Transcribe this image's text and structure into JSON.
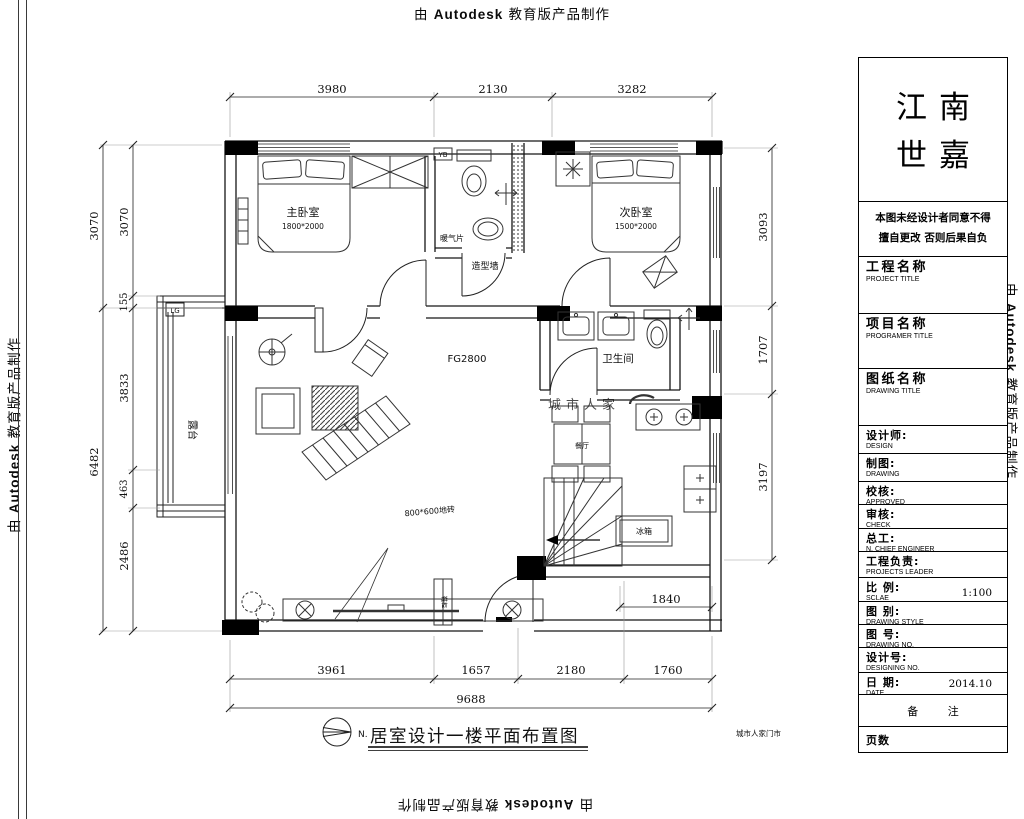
{
  "watermark": {
    "prefix": "由 ",
    "brand": "Autodesk",
    "suffix": " 教育版产品制作"
  },
  "sheet": {
    "brand_name_line1": "江南",
    "brand_name_line2": "世嘉",
    "notice_line1": "本图未经设计者同意不得",
    "notice_line2": "擅自更改 否则后果自负",
    "fields": [
      {
        "label": "工程名称",
        "sub": "PROJECT TITLE",
        "value": ""
      },
      {
        "label": "项目名称",
        "sub": "PROGRAMER TITLE",
        "value": ""
      },
      {
        "label": "图纸名称",
        "sub": "DRAWING TITLE",
        "value": ""
      },
      {
        "label": "设计师:",
        "sub": "DESIGN",
        "value": ""
      },
      {
        "label": "制图:",
        "sub": "DRAWING",
        "value": ""
      },
      {
        "label": "校核:",
        "sub": "APPROVED",
        "value": ""
      },
      {
        "label": "审核:",
        "sub": "CHECK",
        "value": ""
      },
      {
        "label": "总工:",
        "sub": "N. CHIEF ENGINEER",
        "value": ""
      },
      {
        "label": "工程负责:",
        "sub": "PROJECTS LEADER",
        "value": ""
      },
      {
        "label": "比 例:",
        "sub": "SCLAE",
        "value": "1:100"
      },
      {
        "label": "图 别:",
        "sub": "DRAWING STYLE",
        "value": ""
      },
      {
        "label": "图 号:",
        "sub": "DRAWING NO.",
        "value": ""
      },
      {
        "label": "设计号:",
        "sub": "DESIGNING NO.",
        "value": ""
      },
      {
        "label": "日 期:",
        "sub": "DATE",
        "value": "2014.10"
      }
    ],
    "remark": "备 注",
    "pages": "页数"
  },
  "plan": {
    "rooms": {
      "master_bedroom": "主卧室",
      "master_bed_size": "1800*2000",
      "second_bedroom": "次卧室",
      "second_bed_size": "1500*2000",
      "bathroom": "卫生间",
      "terrace": "露台",
      "dining": "餐厅"
    },
    "annotations": {
      "radiator": "暖气片",
      "feature_wall": "造型墙",
      "ceiling": "FG2800",
      "fridge": "冰箱",
      "shoe_cabinet": "鞋柜",
      "floor_tile": "800*600地砖",
      "marker_yb": "YB",
      "marker_lg": "LG",
      "stamp_center": "城市人家",
      "stamp_corner": "城市人家门市"
    },
    "dims": {
      "top": [
        "3980",
        "2130",
        "3282"
      ],
      "left_outer": [
        "3070",
        "6482"
      ],
      "left_inner": [
        "3070",
        "155",
        "3833",
        "463",
        "2486"
      ],
      "right": [
        "3093",
        "1707",
        "3197"
      ],
      "kitchen": "1840",
      "bottom": [
        "3961",
        "1657",
        "2180",
        "1760"
      ],
      "total": "9688"
    }
  },
  "footer": {
    "north": "N.",
    "title": "居室设计一楼平面布置图"
  }
}
